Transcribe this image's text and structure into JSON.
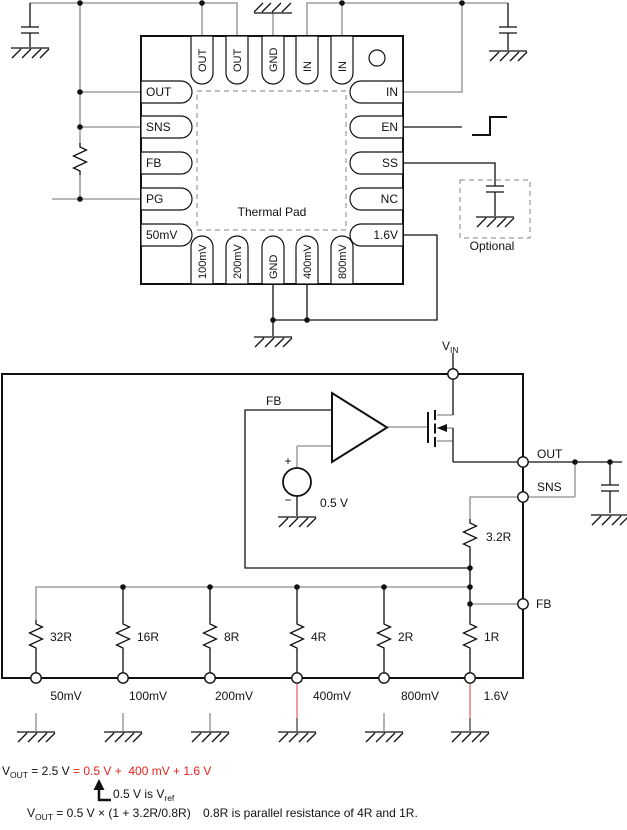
{
  "top_circuit": {
    "package": {
      "pins_left": [
        "OUT",
        "SNS",
        "FB",
        "PG",
        "50mV"
      ],
      "pins_right": [
        "IN",
        "EN",
        "SS",
        "NC",
        "1.6V"
      ],
      "pins_top": [
        "OUT",
        "OUT",
        "GND",
        "IN",
        "IN"
      ],
      "pins_bottom": [
        "100mV",
        "200mV",
        "GND",
        "400mV",
        "800mV"
      ],
      "thermal_pad_label": "Thermal Pad"
    },
    "optional_label": "Optional"
  },
  "block": {
    "vin_base": "V",
    "vin_sub": "IN",
    "fb_wire_label": "FB",
    "plus": "+",
    "minus": "−",
    "vref_value": "0.5 V",
    "out_terminal": "OUT",
    "sns_terminal": "SNS",
    "fb_terminal": "FB",
    "sense_resistor": "3.2R",
    "ladder_resistors": [
      "32R",
      "16R",
      "8R",
      "4R",
      "2R",
      "1R"
    ],
    "tap_labels": [
      "50mV",
      "100mV",
      "200mV",
      "400mV",
      "800mV",
      "1.6V"
    ]
  },
  "formulas": {
    "line1_var": "V",
    "line1_var_sub": "OUT",
    "line1_black": " = 2.5 V ",
    "line1_red": "= 0.5 V +  400 mV + 1.6 V",
    "line2_text": "0.5 V is V",
    "line2_sub": "ref",
    "line3_var": "V",
    "line3_var_sub": "OUT",
    "line3_main": " = 0.5 V × (1 + 3.2R/0.8R)",
    "line3_note": "0.8R is parallel resistance of 4R and 1R."
  },
  "colors": {
    "ink": "#000000",
    "wire_gray": "#8c8c8c",
    "highlight_red_text": "#e8231f",
    "highlight_red_wire": "#f08080",
    "dashed_gray": "#999999"
  }
}
